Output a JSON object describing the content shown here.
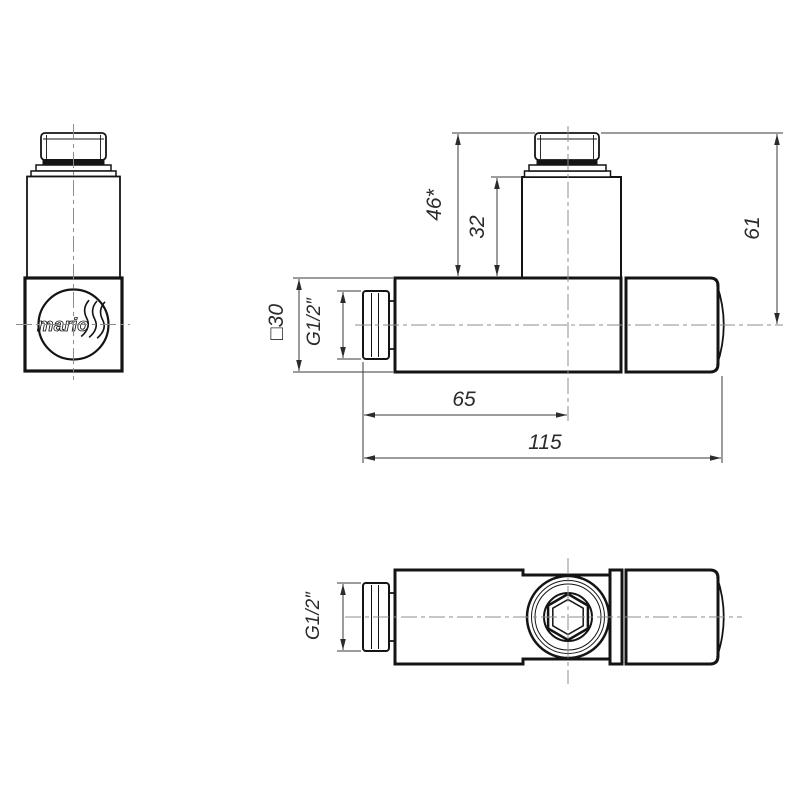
{
  "drawing": {
    "title": "angle-valve-technical-drawing",
    "colors": {
      "background": "#ffffff",
      "object_line": "#141414",
      "dimension_line": "#3a3a3a",
      "centerline": "#8c8c8c",
      "text": "#2b2b2b"
    },
    "logo": {
      "text": "mario"
    },
    "dims": {
      "knob_total_height": "46*",
      "knob_stem_height": "32",
      "axis_to_knob_top": "61",
      "body_square_size": "□30",
      "thread_side_view": "G1/2″",
      "thread_bottom_view": "G1/2″",
      "tail_to_axis_length": "65",
      "total_length": "115"
    }
  }
}
